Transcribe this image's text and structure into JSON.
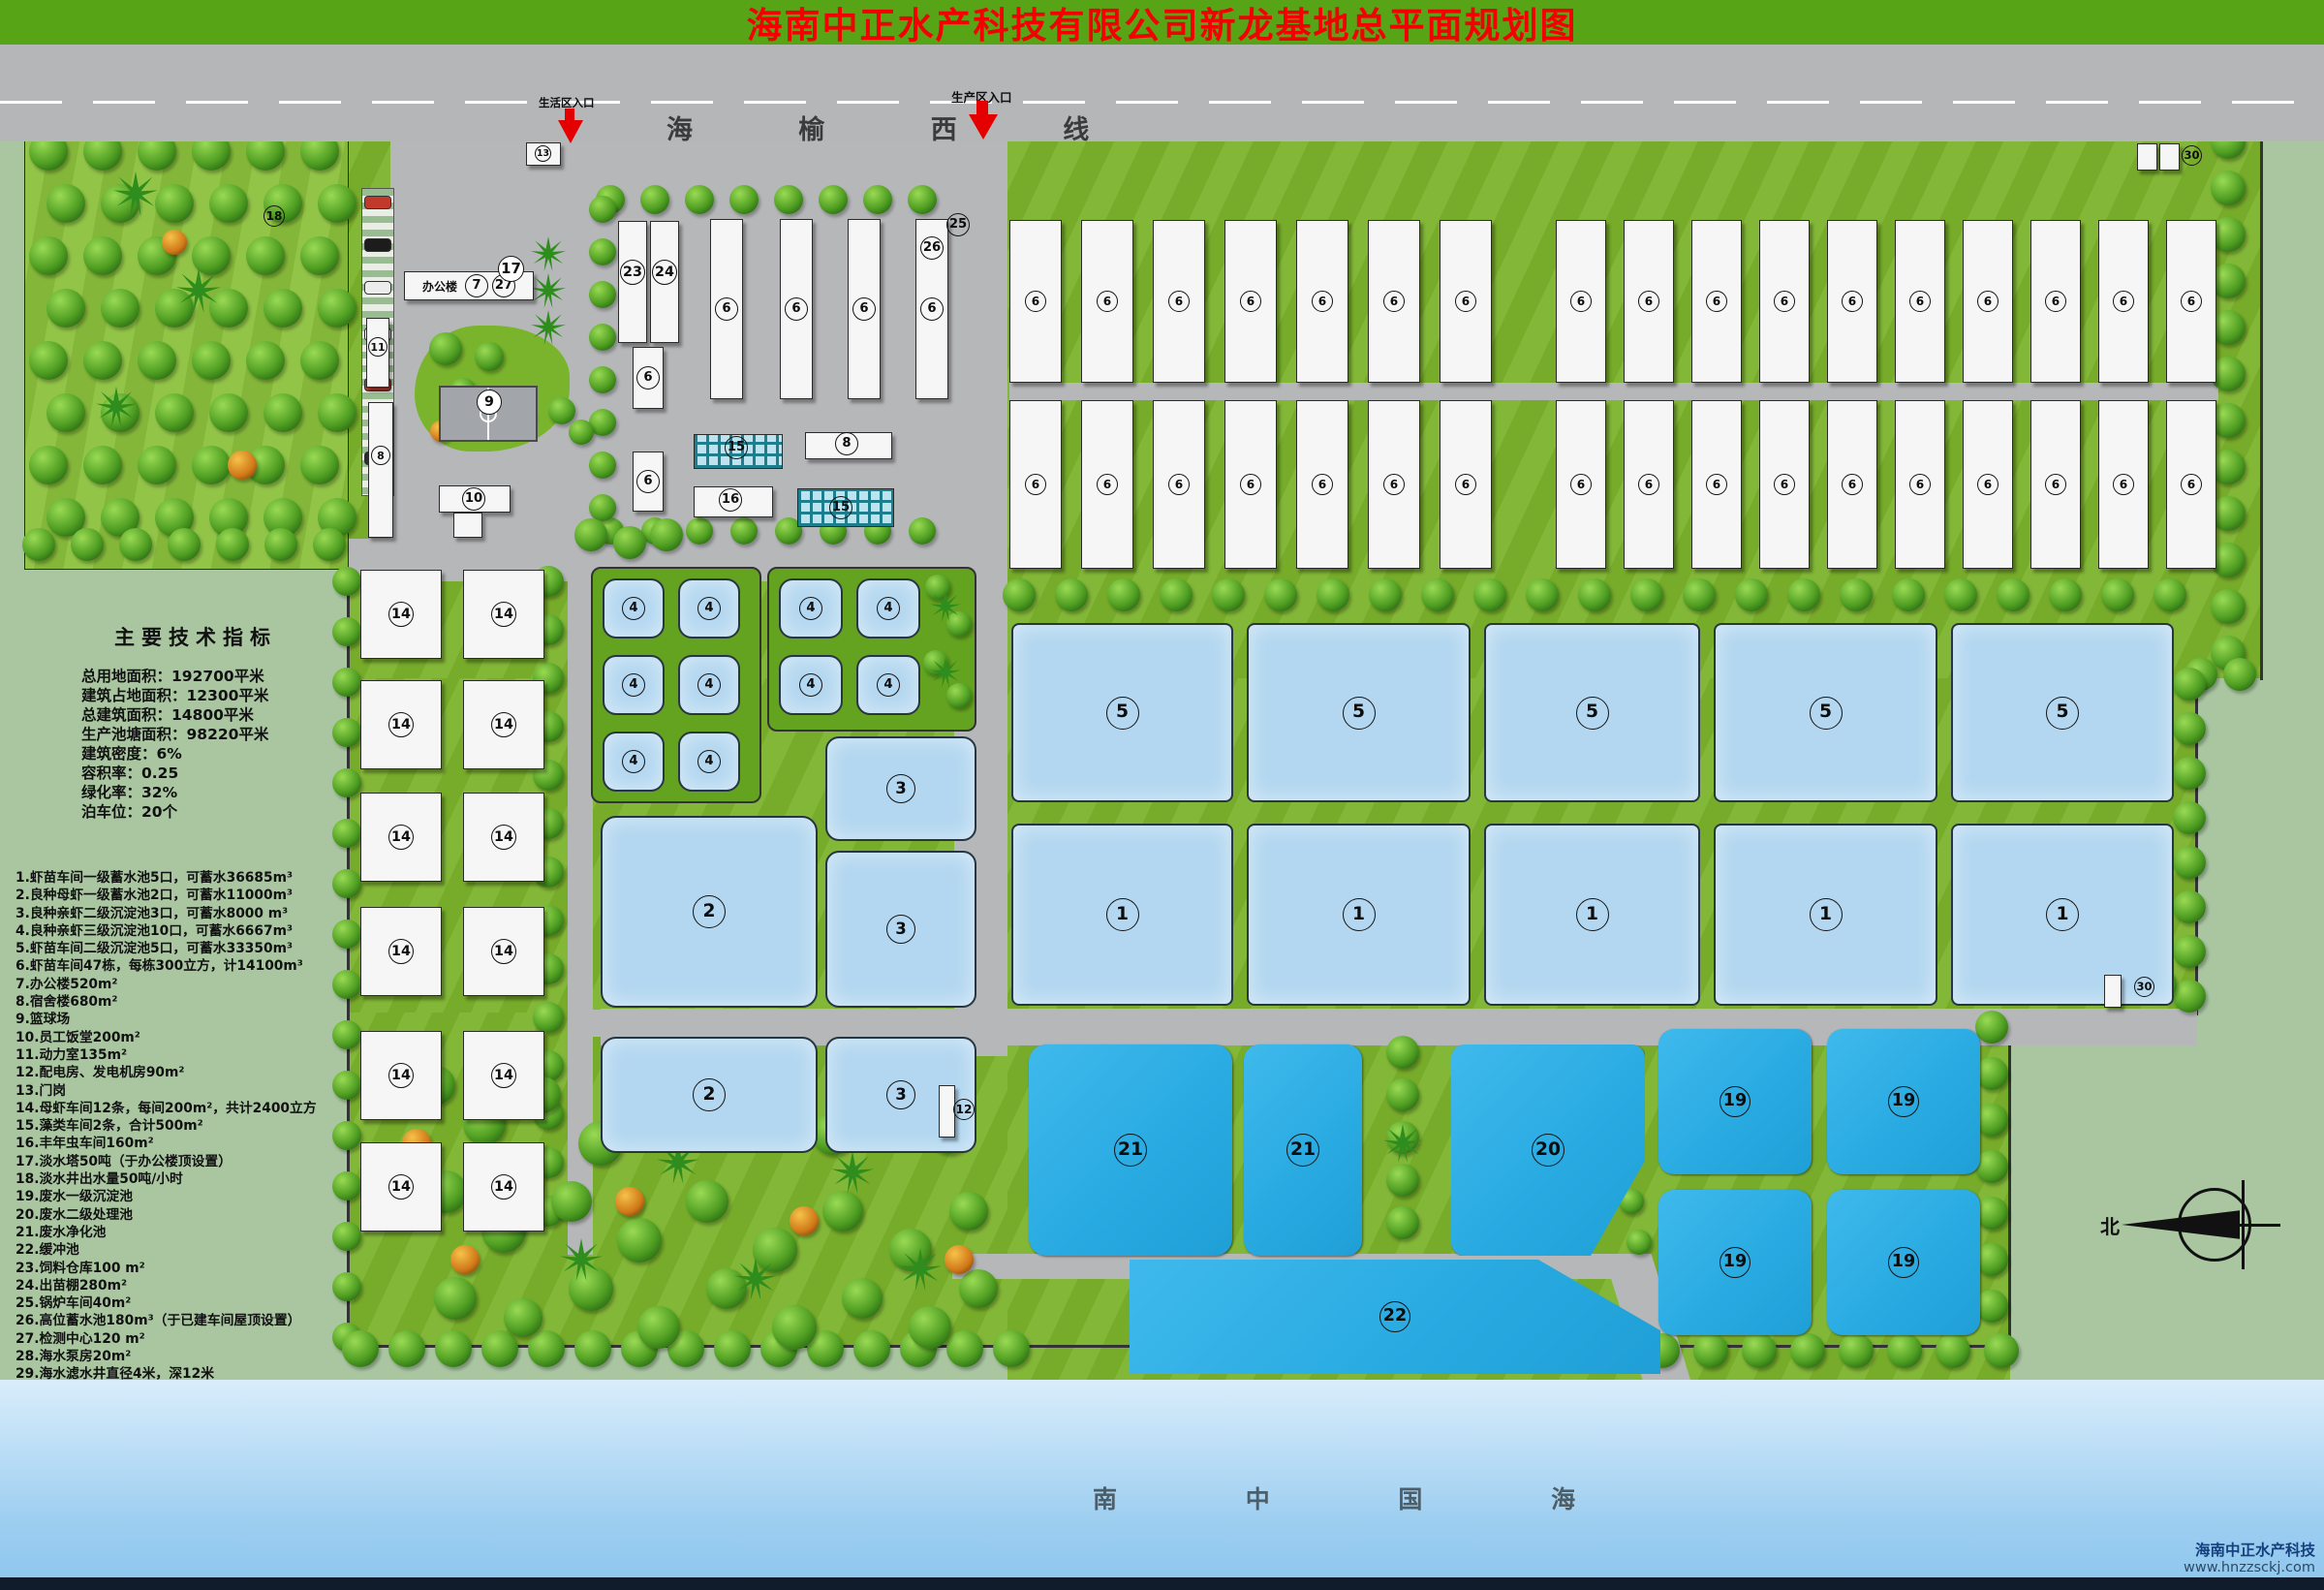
{
  "title": "海南中正水产科技有限公司新龙基地总平面规划图",
  "highway": {
    "name": "海 榆 西 线",
    "entrance_life": "生活区入口",
    "entrance_production": "生产区入口"
  },
  "indicators": {
    "heading": "主要技术指标",
    "lines": [
      "总用地面积：192700平米",
      "建筑占地面积：12300平米",
      "总建筑面积：14800平米",
      "生产池塘面积：98220平米",
      "建筑密度：6%",
      "容积率：0.25",
      "绿化率：32%",
      "泊车位：20个"
    ]
  },
  "legend_items": [
    "1.虾苗车间一级蓄水池5口，可蓄水36685m³",
    "2.良种母虾一级蓄水池2口，可蓄水11000m³",
    "3.良种亲虾二级沉淀池3口，可蓄水8000 m³",
    "4.良种亲虾三级沉淀池10口，可蓄水6667m³",
    "5.虾苗车间二级沉淀池5口，可蓄水33350m³",
    "6.虾苗车间47栋，每栋300立方，计14100m³",
    "7.办公楼520m²",
    "8.宿舍楼680m²",
    "9.篮球场",
    "10.员工饭堂200m²",
    "11.动力室135m²",
    "12.配电房、发电机房90m²",
    "13.门岗",
    "14.母虾车间12条，每间200m²，共计2400立方",
    "15.藻类车间2条，合计500m²",
    "16.丰年虫车间160m²",
    "17.淡水塔50吨（于办公楼顶设置）",
    "18.淡水井出水量50吨/小时",
    "19.废水一级沉淀池",
    "20.废水二级处理池",
    "21.废水净化池",
    "22.缓冲池",
    "23.饲料仓库100 m²",
    "24.出苗棚280m²",
    "25.锅炉车间40m²",
    "26.高位蓄水池180m³（于已建车间屋顶设置）",
    "27.检测中心120 m²",
    "28.海水泵房20m²",
    "29.海水滤水井直径4米，深12米",
    "30.岗位房、饲料库房 共250m²"
  ],
  "office_label": "办公楼",
  "sea_label": "南 中 国 海",
  "compass_north": "北",
  "logo": {
    "company": "海南中正水产科技",
    "website": "www.hnzzsckj.com"
  },
  "marker_labels": {
    "p5": "5",
    "p1": "1",
    "p4": "4",
    "p3": "3",
    "p2": "2",
    "w6": "6",
    "b14": "14",
    "c19": "19",
    "c20": "20",
    "c21": "21",
    "c22": "22",
    "t7": "7",
    "t27": "27",
    "t17": "17",
    "t18": "18",
    "t13": "13",
    "t11": "11",
    "t8": "8",
    "t9": "9",
    "t10": "10",
    "t12": "12",
    "t15": "15",
    "t16": "16",
    "t23": "23",
    "t24": "24",
    "t25": "25",
    "t26": "26",
    "t28": "28",
    "t29": "29",
    "t30": "30"
  },
  "colors": {
    "title_bg": "#57a517",
    "title_fg": "#f40000",
    "road": "#b6b7b9",
    "grass": "#7cb32c",
    "park": "#8bc13c",
    "pond_light": "#b3d7f0",
    "pond_cyan": "#29abe2",
    "sea_top": "#d9edfb",
    "sea_bottom": "#8ec6ee",
    "footer": "#101b2b"
  }
}
